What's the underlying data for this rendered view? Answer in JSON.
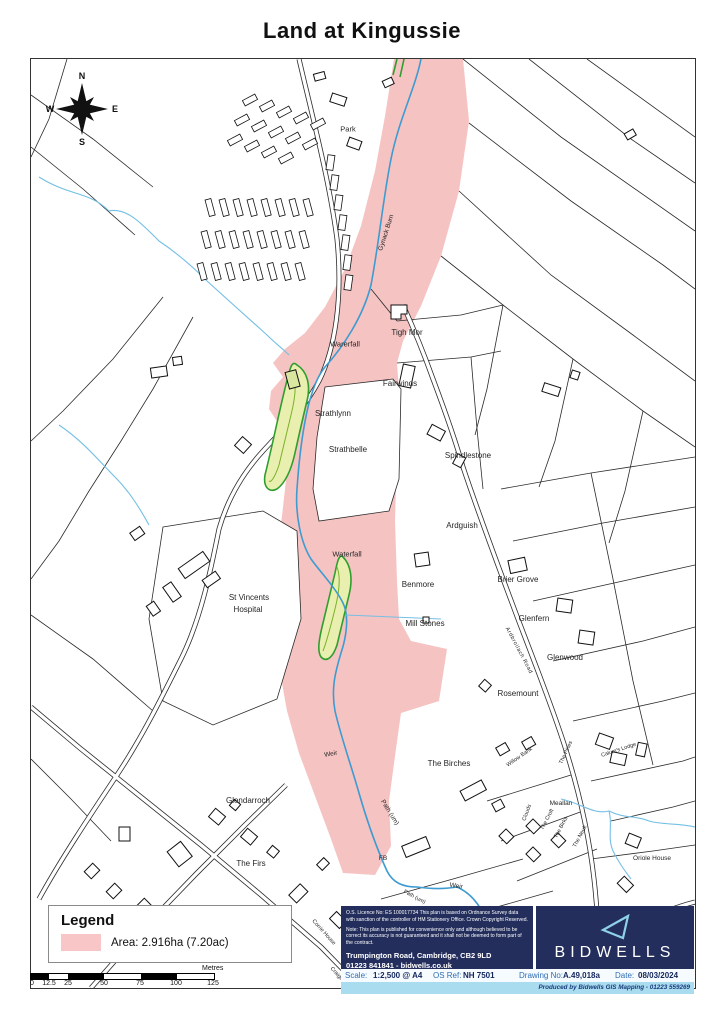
{
  "title": "Land at Kingussie",
  "compass": {
    "n": "N",
    "e": "E",
    "s": "S",
    "w": "W"
  },
  "map": {
    "labels": {
      "park": "Park",
      "gynack_burn": "Gynack Burn",
      "warerfall": "Warerfall",
      "tigh_mor": "Tigh Mor",
      "fairwinds": "Fairwinds",
      "strathlynn": "Strathlynn",
      "strathbelle": "Strathbelle",
      "spindlestone": "Spindlestone",
      "ardguish": "Ardguish",
      "benmore": "Benmore",
      "brier_grove": "Brier Grove",
      "mill_stones": "Mill Stones",
      "glenfern": "Glenfern",
      "glenwood": "Glenwood",
      "rosemount": "Rosemount",
      "ardbroilach_road": "Ardbroilach Road",
      "st_vincents_line1": "St Vincents",
      "st_vincents_line2": "Hospital",
      "waterfall": "Waterfall",
      "weir_upper": "Weir",
      "the_birches": "The Birches",
      "glendarroch": "Glendarroch",
      "path_um_upper": "Path (um)",
      "the_firs": "The Firs",
      "fb": "FB",
      "path_um_lower": "Path (um)",
      "weir_lower": "Weir",
      "willow_bank": "Willow Bank",
      "the_pines": "The Pines",
      "calums_lodge": "Calum's Lodge",
      "meallan": "Meallan",
      "clouds": "Clouds",
      "the_croft": "The Croft",
      "the_birks": "The Birks",
      "the_neuk": "The Neuk",
      "oriole_house": "Oriole House",
      "corrie_house": "Corrie House",
      "craigentor": "Craigentor"
    }
  },
  "legend": {
    "title": "Legend",
    "area_label": "Area: 2.916ha (7.20ac)",
    "swatch_color": "#f8c6c6"
  },
  "scalebar": {
    "ticks": [
      "0",
      "12.5",
      "25",
      "50",
      "75",
      "100",
      "125"
    ],
    "unit": "Metres"
  },
  "notes": {
    "licence": "O.S. Licence No: ES 100017734 This plan is based on Ordnance Survey data with sanction of the controller of HM Stationery Office. Crown Copyright Reserved.",
    "disclaimer": "Note: This plan is published for convenience only and although believed to be correct its accuracy is not guaranteed and it shall not be deemed to form part of the contract.",
    "address": "Trumpington Road, Cambridge, CB2 9LD",
    "contact": "01223 841841  -  bidwells.co.uk"
  },
  "branding": {
    "name": "BIDWELLS",
    "triangle_color": "#8fd2e8"
  },
  "footer": {
    "scale_label": "Scale:",
    "scale_value": "1:2,500  @ A4",
    "os_ref_label": "OS Ref:",
    "os_ref_value": "NH 7501",
    "drawing_label": "Drawing No:",
    "drawing_value": "A.49,018a",
    "date_label": "Date:",
    "date_value": "08/03/2024",
    "produced_by": "Produced by Bidwells GIS Mapping  -  01223 559269"
  },
  "colors": {
    "area_pink": "#f6c3c3",
    "stream_blue": "#3d9bd0",
    "tributary_blue": "#74bfe4",
    "tree_green": "#2f9e2f",
    "navy": "#232e5c",
    "footer_strip_blue": "#aadcf0"
  }
}
